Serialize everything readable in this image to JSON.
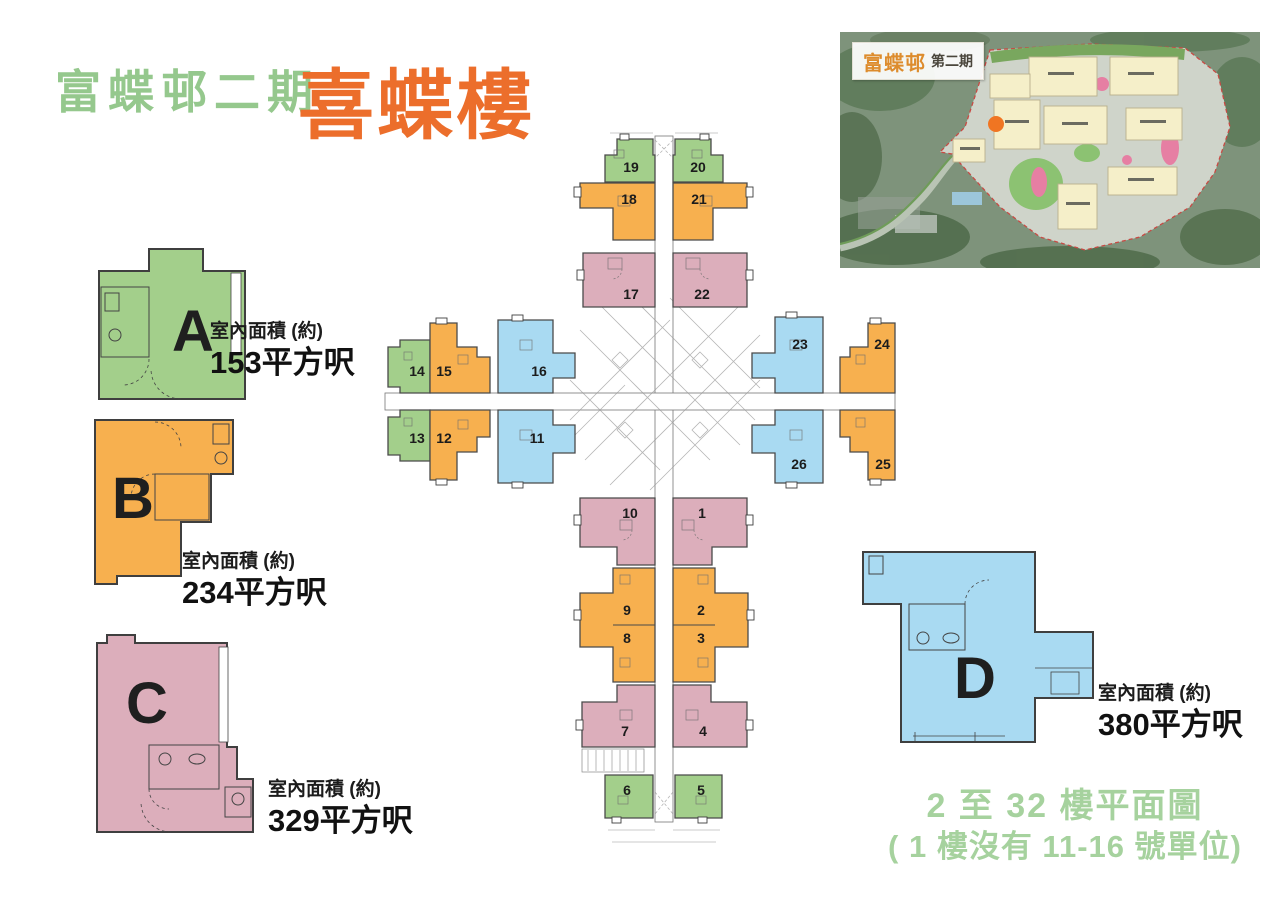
{
  "title": {
    "estate": "富蝶邨二期",
    "building": "喜蝶樓"
  },
  "site_map": {
    "estate_label": "富蝶邨",
    "phase_label": "第二期"
  },
  "unit_types": [
    {
      "letter": "A",
      "area_label": "室內面積 (約)",
      "area_value": "153平方呎",
      "color": "#a3cf8b"
    },
    {
      "letter": "B",
      "area_label": "室內面積 (約)",
      "area_value": "234平方呎",
      "color": "#f7b04f"
    },
    {
      "letter": "C",
      "area_label": "室內面積 (約)",
      "area_value": "329平方呎",
      "color": "#dcaebb"
    },
    {
      "letter": "D",
      "area_label": "室內面積 (約)",
      "area_value": "380平方呎",
      "color": "#a9daf2"
    }
  ],
  "floor_plan": {
    "units": [
      {
        "no": "1",
        "type": "C"
      },
      {
        "no": "2",
        "type": "B"
      },
      {
        "no": "3",
        "type": "B"
      },
      {
        "no": "4",
        "type": "C"
      },
      {
        "no": "5",
        "type": "A"
      },
      {
        "no": "6",
        "type": "A"
      },
      {
        "no": "7",
        "type": "C"
      },
      {
        "no": "8",
        "type": "B"
      },
      {
        "no": "9",
        "type": "B"
      },
      {
        "no": "10",
        "type": "C"
      },
      {
        "no": "11",
        "type": "D"
      },
      {
        "no": "12",
        "type": "B"
      },
      {
        "no": "13",
        "type": "A"
      },
      {
        "no": "14",
        "type": "A"
      },
      {
        "no": "15",
        "type": "B"
      },
      {
        "no": "16",
        "type": "D"
      },
      {
        "no": "17",
        "type": "C"
      },
      {
        "no": "18",
        "type": "B"
      },
      {
        "no": "19",
        "type": "A"
      },
      {
        "no": "20",
        "type": "A"
      },
      {
        "no": "21",
        "type": "B"
      },
      {
        "no": "22",
        "type": "C"
      },
      {
        "no": "23",
        "type": "D"
      },
      {
        "no": "24",
        "type": "B"
      },
      {
        "no": "25",
        "type": "B"
      },
      {
        "no": "26",
        "type": "D"
      }
    ]
  },
  "footer": {
    "line1": "2 至 32 樓平面圖",
    "line2": "( 1 樓沒有 11-16 號單位)"
  },
  "colors": {
    "unit_a": "#a3cf8b",
    "unit_b": "#f7b04f",
    "unit_c": "#dcaebb",
    "unit_d": "#a9daf2",
    "outline": "#4a4a4a",
    "title_green": "#95c88d",
    "title_orange": "#ec6e2b",
    "footer_green": "#a6d29e",
    "marker_orange": "#f07522"
  }
}
